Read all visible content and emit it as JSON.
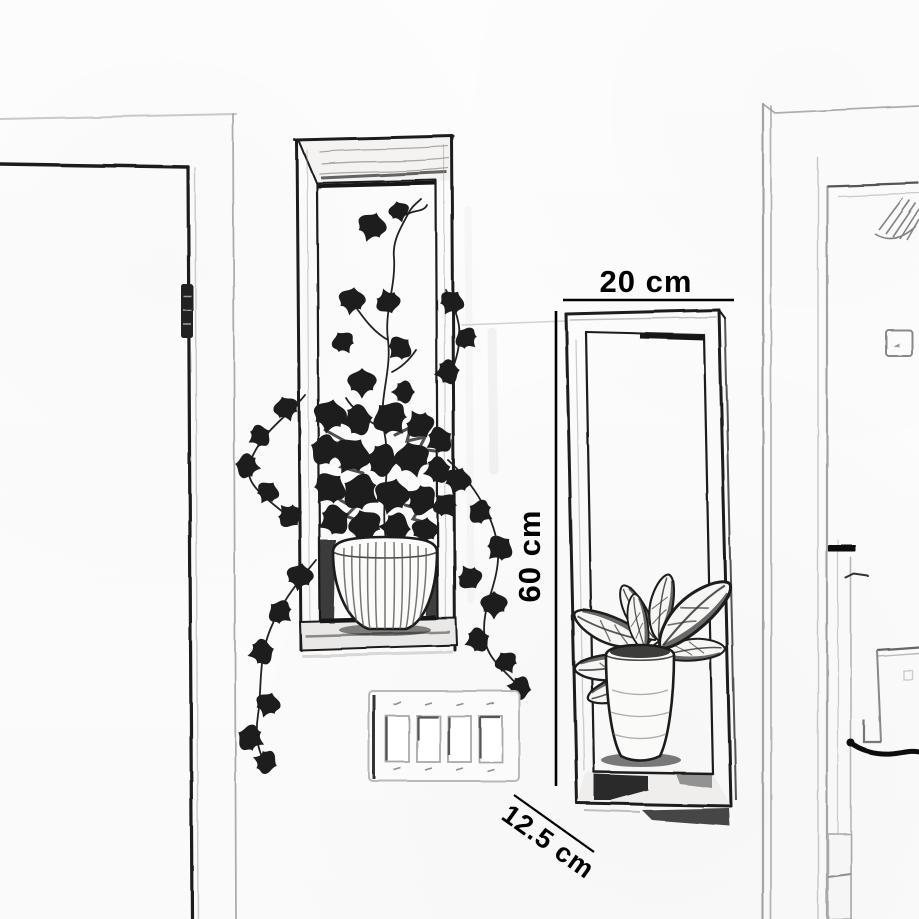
{
  "dimensions": {
    "width_label": "20 cm",
    "height_label": "60 cm",
    "depth_label": "12.5 cm"
  },
  "colors": {
    "background": "#fdfdfd",
    "ink": "#1c1c1c",
    "pencil_light": "#9a9a9a",
    "label_text": "#000000"
  }
}
